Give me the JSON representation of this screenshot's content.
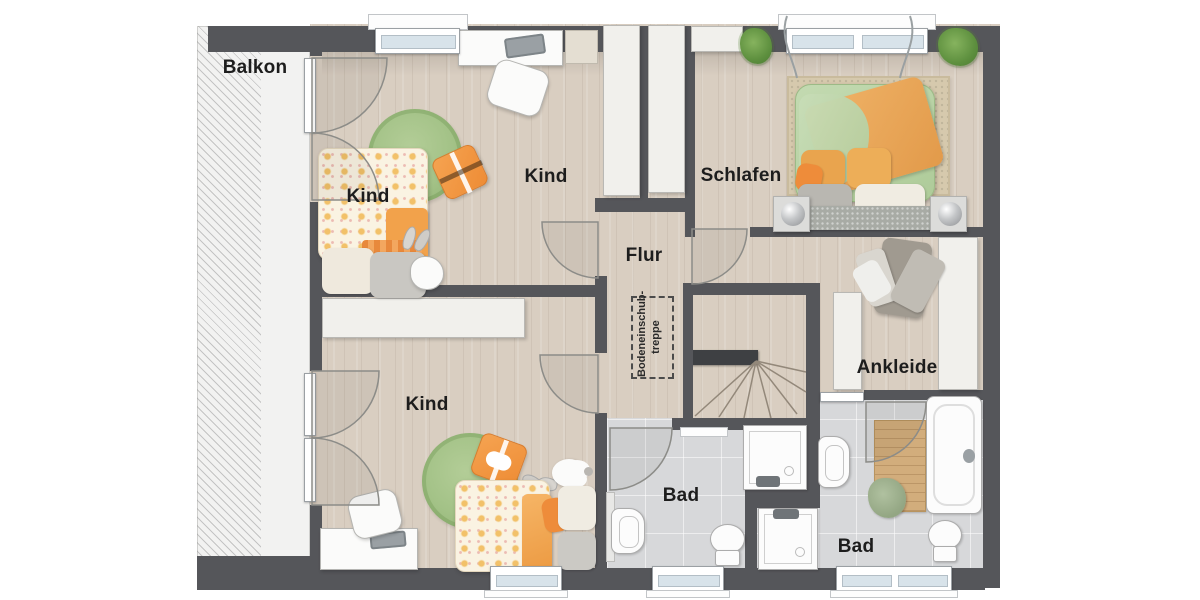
{
  "floorplan": {
    "type": "residential-upper-floor-plan",
    "rooms": {
      "balkon": {
        "label": "Balkon"
      },
      "kind_top_bed": {
        "label": "Kind"
      },
      "kind_top": {
        "label": "Kind"
      },
      "schlafen": {
        "label": "Schlafen"
      },
      "flur": {
        "label": "Flur"
      },
      "kind_bottom": {
        "label": "Kind"
      },
      "bad_left": {
        "label": "Bad"
      },
      "bad_right": {
        "label": "Bad"
      },
      "ankleide": {
        "label": "Ankleide"
      },
      "bodeneinschubtreppe": {
        "label_line1": "Bodeneinschub-",
        "label_line2": "treppe"
      }
    },
    "colors": {
      "wall": "#55565a",
      "wood_floor": "#d9cec1",
      "bath_floor": "#d7d8da",
      "balcony_floor": "#f2f2f1",
      "rug_green": "#a3c287",
      "accent_orange": "#f0913c",
      "bed_green": "#b7d2a2",
      "furniture_white": "#f1f0ec",
      "window_glass": "#d8e3ea",
      "stair_edge": "#3e4043"
    }
  }
}
